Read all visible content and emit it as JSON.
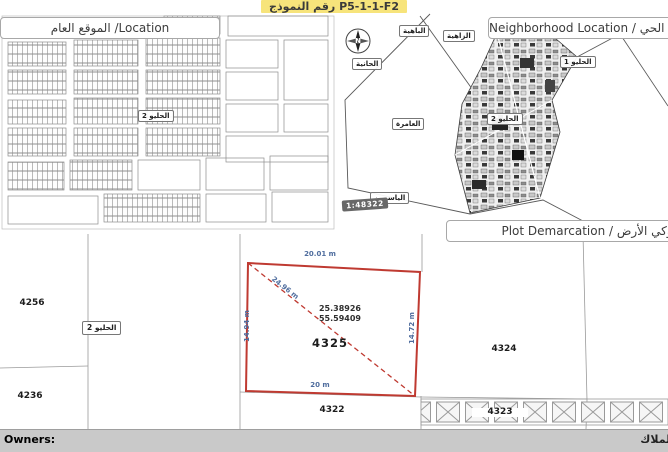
{
  "form": {
    "number": "رقم النموذج P5-1-1-F2"
  },
  "location_panel": {
    "title": "الموقع العام /Location",
    "area_badge": "الحليو 2"
  },
  "neighborhood_panel": {
    "title": "Neighborhood Location / موقع الحي",
    "compass_label": "N",
    "scale": "1:48322",
    "districts": {
      "bahia": "الباهية",
      "zahia": "الزاهية",
      "hania": "الحانية",
      "amra": "العامرة",
      "yasmeen": "الياسمين",
      "helio1": "الحليو 1",
      "helio2": "الحليو 2"
    }
  },
  "plot_panel": {
    "title": "Plot Demarcation / كروكي الأرض",
    "area_badge": "الحليو 2",
    "target_plot": {
      "number": "4325",
      "latitude": "25.38926",
      "longitude": "55.59409",
      "edge_top": "20.01 m",
      "edge_bottom": "20 m",
      "edge_left": "14.94 m",
      "edge_right": "14.72 m",
      "diagonal": "24.96 m"
    },
    "neighbor_plots": {
      "northwest": "4256",
      "southwest": "4236",
      "east": "4324",
      "south": "4322",
      "southeast": "4323"
    }
  },
  "footer": {
    "owners_en": "Owners:",
    "owners_ar": "الملاك"
  },
  "colors": {
    "plot_red": "#bf3a31",
    "measure_blue": "#4f6d9e",
    "highlight_yellow": "#f7e47b",
    "footer_gray": "#c9c9c9"
  }
}
